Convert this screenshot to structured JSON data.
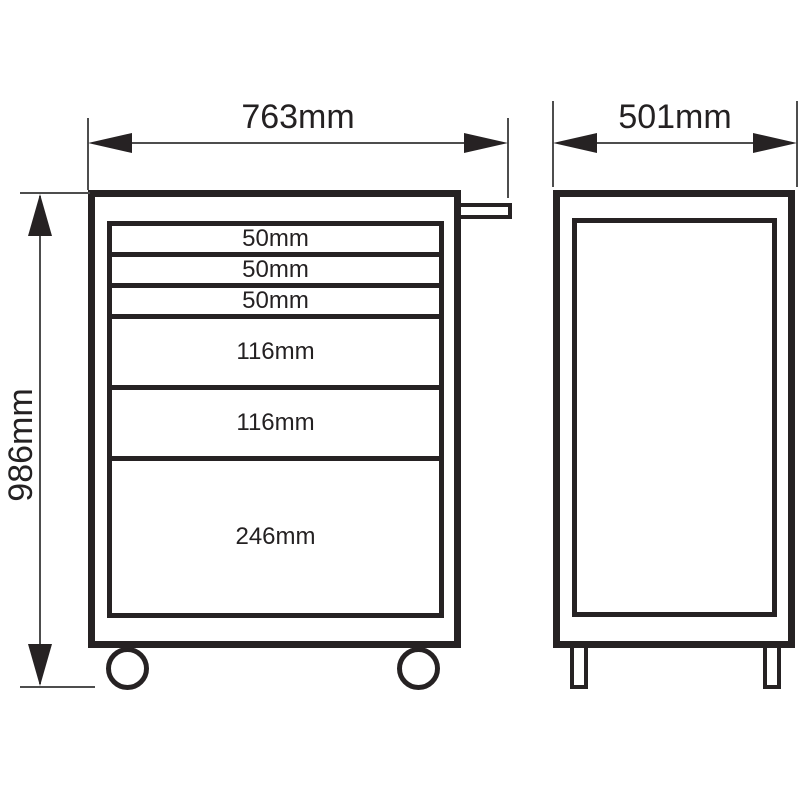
{
  "colors": {
    "line": "#262223",
    "dim_line": "#4d4d4d",
    "background": "#ffffff"
  },
  "dimensions": {
    "width_label": "763mm",
    "depth_label": "501mm",
    "height_label": "986mm"
  },
  "drawers": [
    {
      "label": "50mm"
    },
    {
      "label": "50mm"
    },
    {
      "label": "50mm"
    },
    {
      "label": "116mm"
    },
    {
      "label": "116mm"
    },
    {
      "label": "246mm"
    }
  ]
}
